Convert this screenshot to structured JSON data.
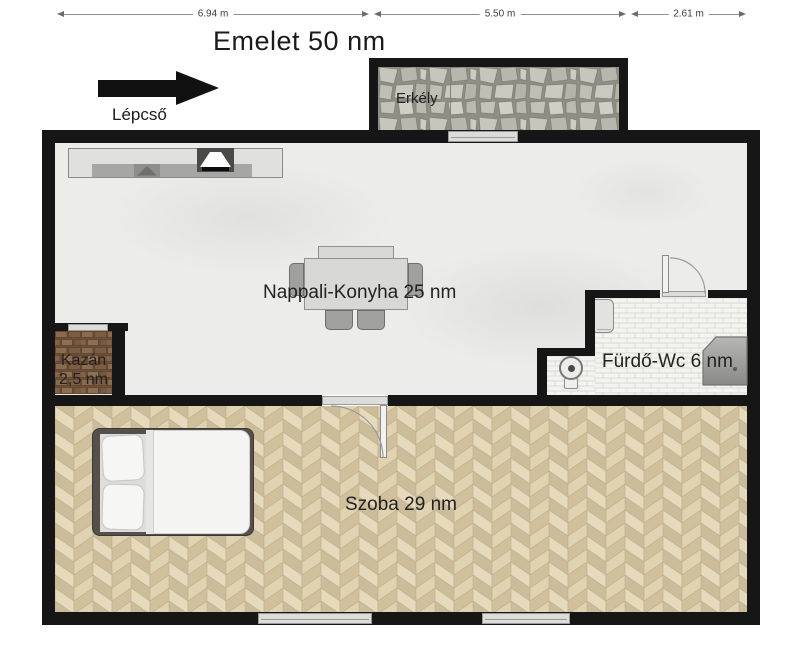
{
  "title": "Emelet 50 nm",
  "dimensions": [
    {
      "label": "6.94 m"
    },
    {
      "label": "5.50 m"
    },
    {
      "label": "2.61 m"
    }
  ],
  "stairs": {
    "label": "Lépcső",
    "arrow_direction": "right"
  },
  "rooms": {
    "balcony": {
      "label": "Erkély"
    },
    "living": {
      "label": "Nappali-Konyha 25 nm"
    },
    "boiler": {
      "line1": "Kazán",
      "line2": "2,5 nm"
    },
    "bathroom": {
      "label": "Fürdő-Wc 6 nm"
    },
    "bedroom": {
      "label": "Szoba 29 nm"
    }
  },
  "colors": {
    "wall": "#161616",
    "living_floor": "#ececea",
    "parquet": "#ddd0b2",
    "stone": "#9a9a90",
    "brick": "#7a5c42",
    "tile": "#f3f3f0",
    "dimension_line": "#8d8d8d"
  }
}
